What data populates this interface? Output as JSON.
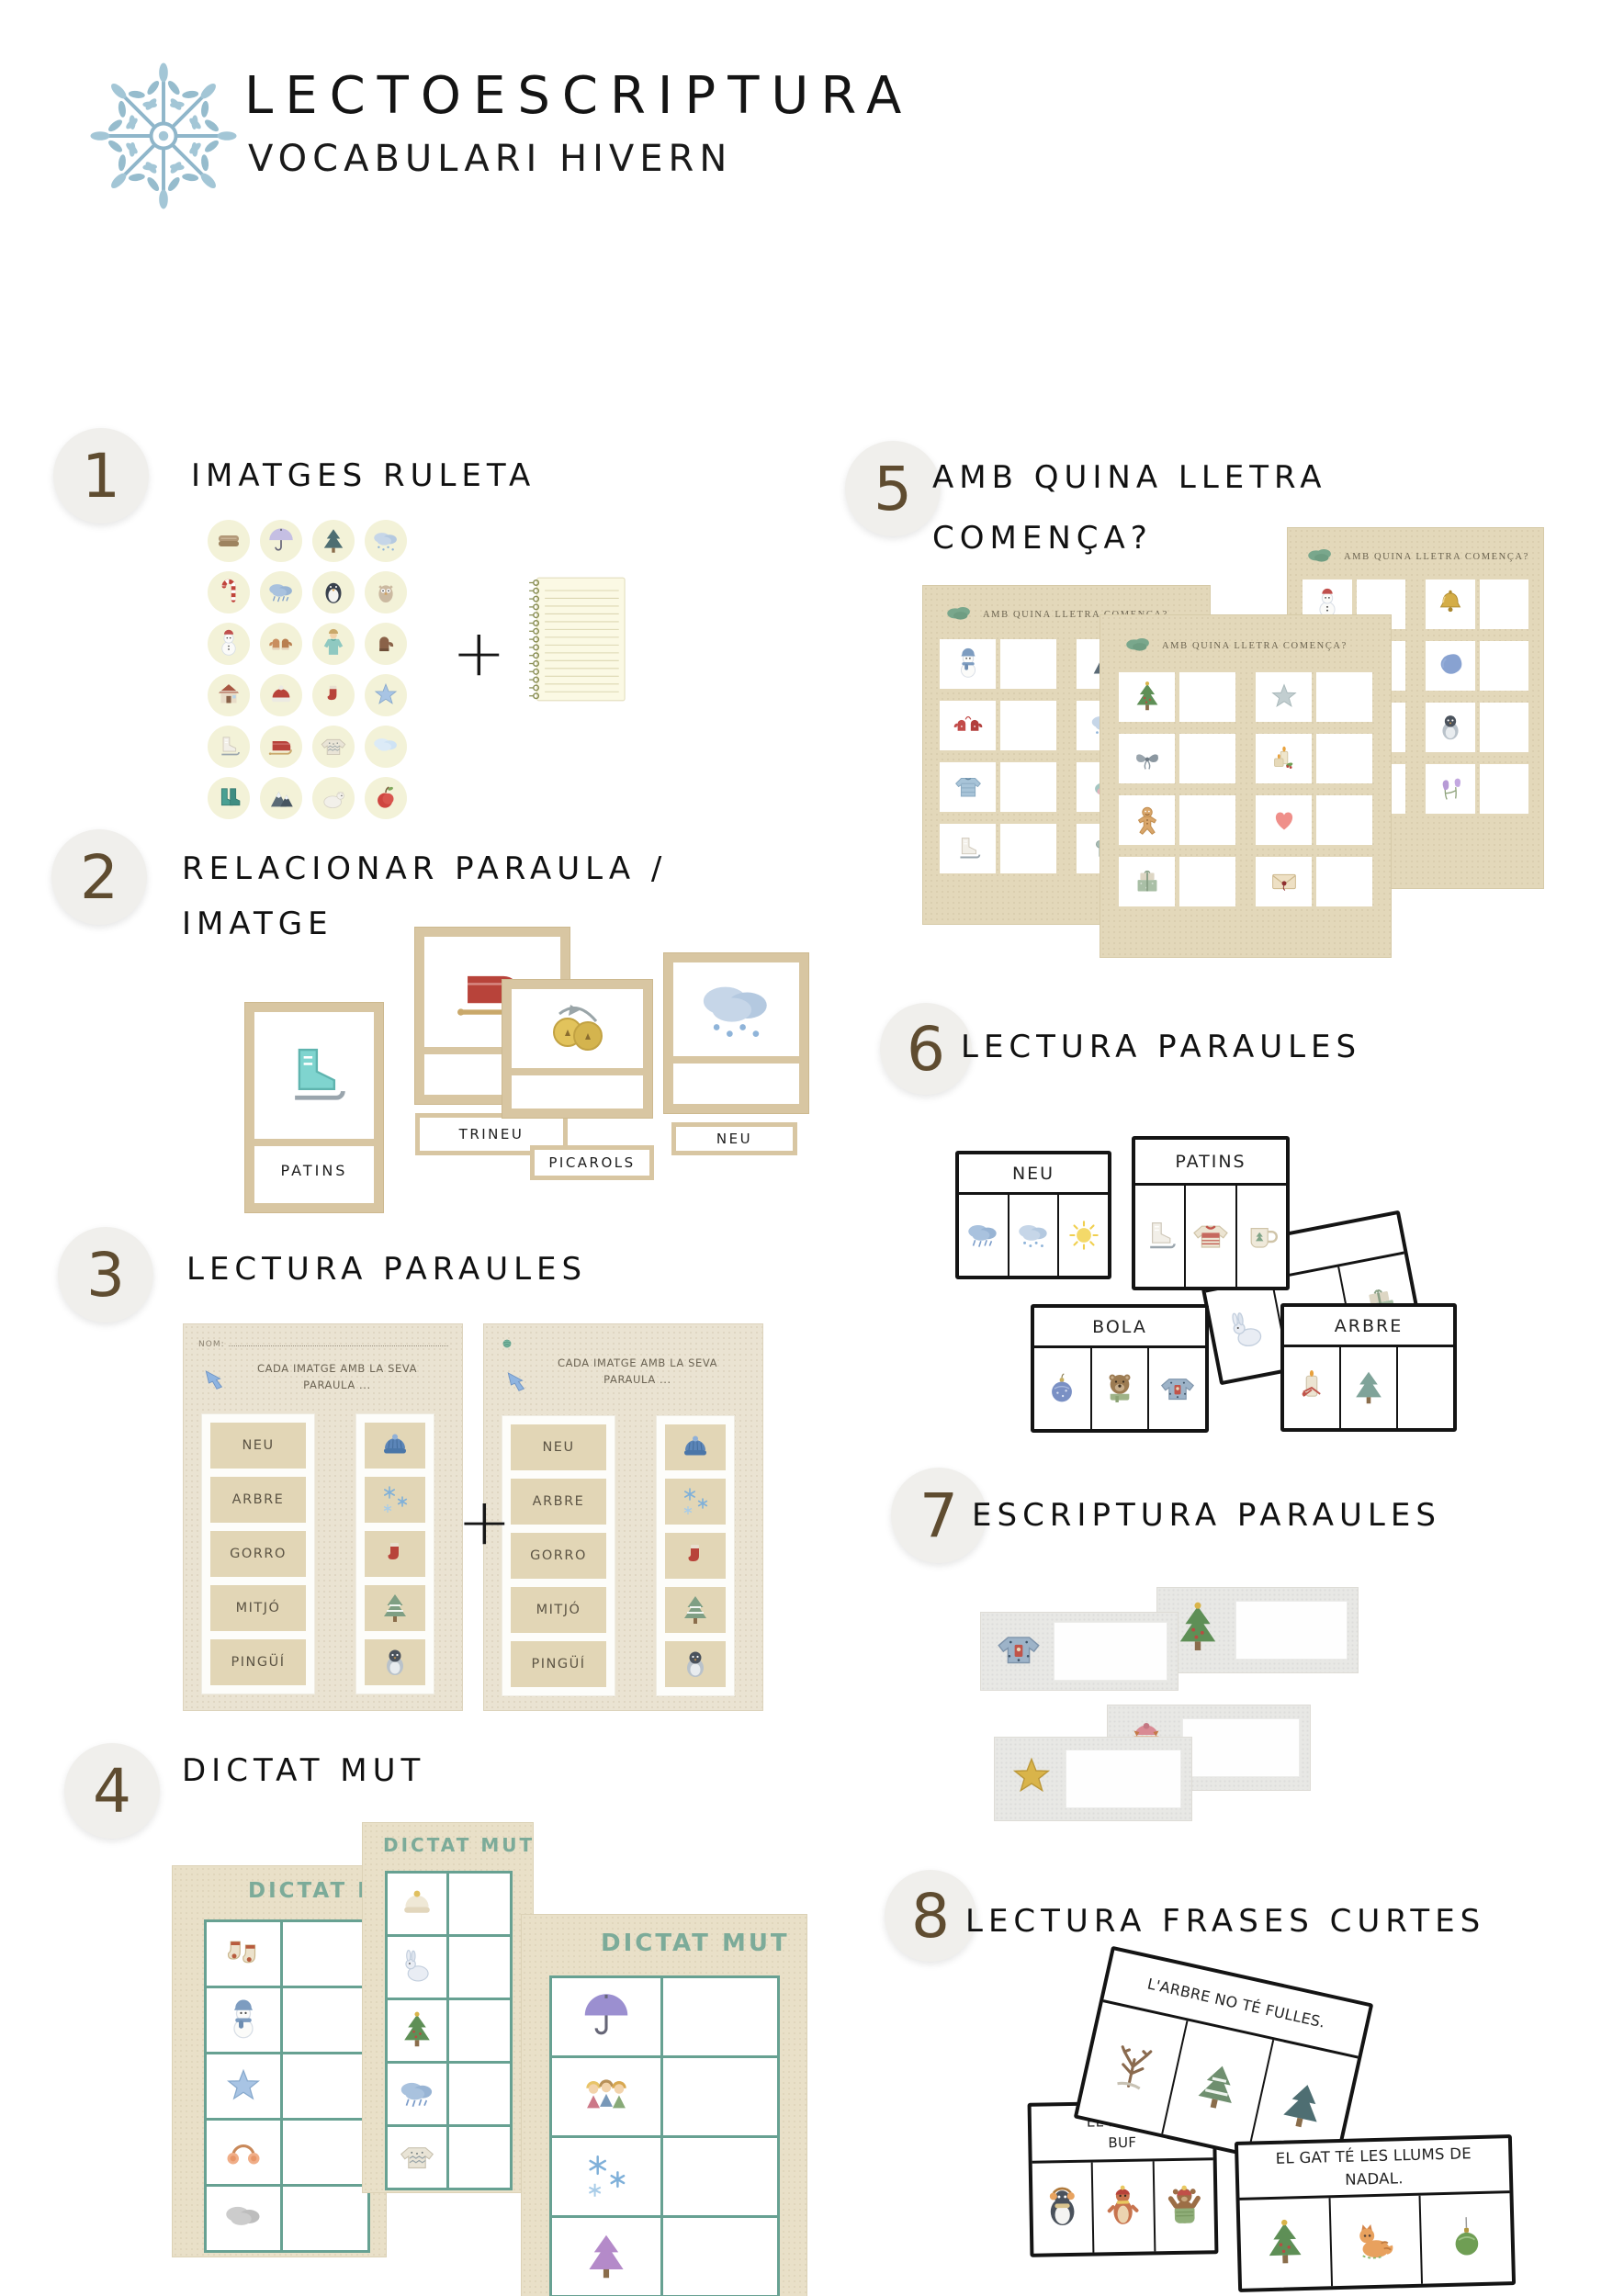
{
  "palette": {
    "accent_teal": "#6FA394",
    "card_tan": "#D8C6A2",
    "sheet_tan": "#E8E0CC",
    "sheet_gray": "#E8E8E5",
    "badge_brown": "#5F4C30",
    "title_teal": "#7CAB99"
  },
  "header": {
    "title": "LECTOESCRIPTURA",
    "subtitle": "VOCABULARI HIVERN",
    "logo_icon": "snowflake-logo"
  },
  "sections": {
    "s1": {
      "number": "1",
      "title": "IMATGES RULETA",
      "plus": "+",
      "notebook_icon": "notebook",
      "icons": [
        "blanket",
        "umbrella",
        "pine-tree",
        "snow-cloud",
        "candy-cane",
        "rain-cloud",
        "penguin",
        "owl",
        "snowman",
        "mittens",
        "coat",
        "brown-mitt",
        "house",
        "red-beanie",
        "red-sock",
        "blue-star",
        "white-skates",
        "sled",
        "white-sweater",
        "ice-cloud",
        "green-boots",
        "mountains",
        "polar-bear",
        "apple"
      ]
    },
    "s2": {
      "number": "2",
      "title_line1": "RELACIONAR PARAULA /",
      "title_line2": "IMATGE",
      "cards": [
        {
          "label": "PATINS",
          "icon": "skates-teal"
        },
        {
          "label": "TRINEU",
          "icon": "sled"
        },
        {
          "label": "PICAROLS",
          "icon": "bells"
        },
        {
          "label": "NEU",
          "icon": "snow-cloud"
        }
      ]
    },
    "s3": {
      "number": "3",
      "title": "LECTURA PARAULES",
      "plus": "+",
      "arrow_icon": "blue-arrow",
      "yarn_icon": "green-yarn",
      "worksheet": {
        "nom_label": "NOM:",
        "instruction_line1": "CADA IMATGE AMB LA SEVA",
        "instruction_line2": "PARAULA ...",
        "words": [
          "NEU",
          "ARBRE",
          "GORRO",
          "MITJÓ",
          "PINGÜÍ"
        ],
        "images": [
          "beanie-blue",
          "snowflakes",
          "red-sock",
          "snowy-tree",
          "penguin-chick"
        ]
      }
    },
    "s4": {
      "number": "4",
      "title": "DICTAT MUT",
      "sheet_title": "DICTAT MUT",
      "sheets": [
        {
          "images": [
            "socks",
            "snowman-scarf",
            "blue-star",
            "earmuffs",
            "gray-cloud"
          ]
        },
        {
          "images": [
            "white-hat",
            "rabbit",
            "christmas-tree",
            "rain-cloud",
            "white-sweater"
          ]
        },
        {
          "images": [
            "umbrella-purple",
            "kids",
            "snowflakes",
            "purple-tree",
            "pants"
          ]
        }
      ]
    },
    "s5": {
      "number": "5",
      "title_line1": "AMB QUINA LLETRA",
      "title_line2": "COMENÇA?",
      "sheet_title": "AMB QUINA LLETRA COMENÇA?",
      "cloud_icon": "green-cloud",
      "sheets": [
        {
          "pairs": [
            [
              "snowman-scarf",
              "mountains"
            ],
            [
              "red-mittens",
              "snow-cloud"
            ],
            [
              "blue-jacket",
              "bird"
            ],
            [
              "white-skates",
              "scarf"
            ]
          ]
        },
        {
          "pairs": [
            [
              "christmas-tree",
              "gray-star"
            ],
            [
              "bow",
              "candles"
            ],
            [
              "gingerbread",
              "heart"
            ],
            [
              "gift",
              "envelope"
            ]
          ]
        },
        {
          "pairs": [
            [
              "snowman",
              "bell-gold"
            ],
            [
              null,
              "blue-blob"
            ],
            [
              null,
              "penguin-chick"
            ],
            [
              null,
              "flowers"
            ]
          ]
        }
      ]
    },
    "s6": {
      "number": "6",
      "title": "LECTURA PARAULES",
      "cards": [
        {
          "label": "NEU",
          "icons": [
            "rain-cloud",
            "snow-cloud",
            "sun"
          ]
        },
        {
          "label": "PATINS",
          "icons": [
            "white-skates",
            "red-sweater",
            "mug"
          ]
        },
        {
          "label": "BOLA",
          "icons": [
            "ornament",
            "bear",
            "blue-sweater"
          ]
        },
        {
          "label": "ARBRE",
          "icons": [
            "candle-bow",
            "teal-tree",
            "berries"
          ]
        }
      ],
      "hidden_card": {
        "label": "",
        "icons": [
          "rabbit",
          "",
          "gift"
        ]
      }
    },
    "s7": {
      "number": "7",
      "title": "ESCRIPTURA PARAULES",
      "strips": [
        {
          "icon": "blue-sweater"
        },
        {
          "icon": "christmas-tree"
        },
        {
          "icon": "fox"
        },
        {
          "icon": "gold-star"
        }
      ]
    },
    "s8": {
      "number": "8",
      "title": "LECTURA FRASES CURTES",
      "cards": [
        {
          "lines": [
            "L'ARBRE NO TÉ FULLES."
          ],
          "icons": [
            "bare-tree",
            "snowy-pine",
            "pine-tree"
          ]
        },
        {
          "lines": [
            "EL PINGÜÍ",
            "BUF"
          ],
          "icons": [
            "penguin-earmuffs",
            "otter",
            "bear-hat"
          ]
        },
        {
          "lines": [
            "EL GAT TÉ LES LLUMS DE",
            "NADAL."
          ],
          "icons": [
            "christmas-tree",
            "cat",
            "green-ornament"
          ]
        }
      ]
    }
  }
}
